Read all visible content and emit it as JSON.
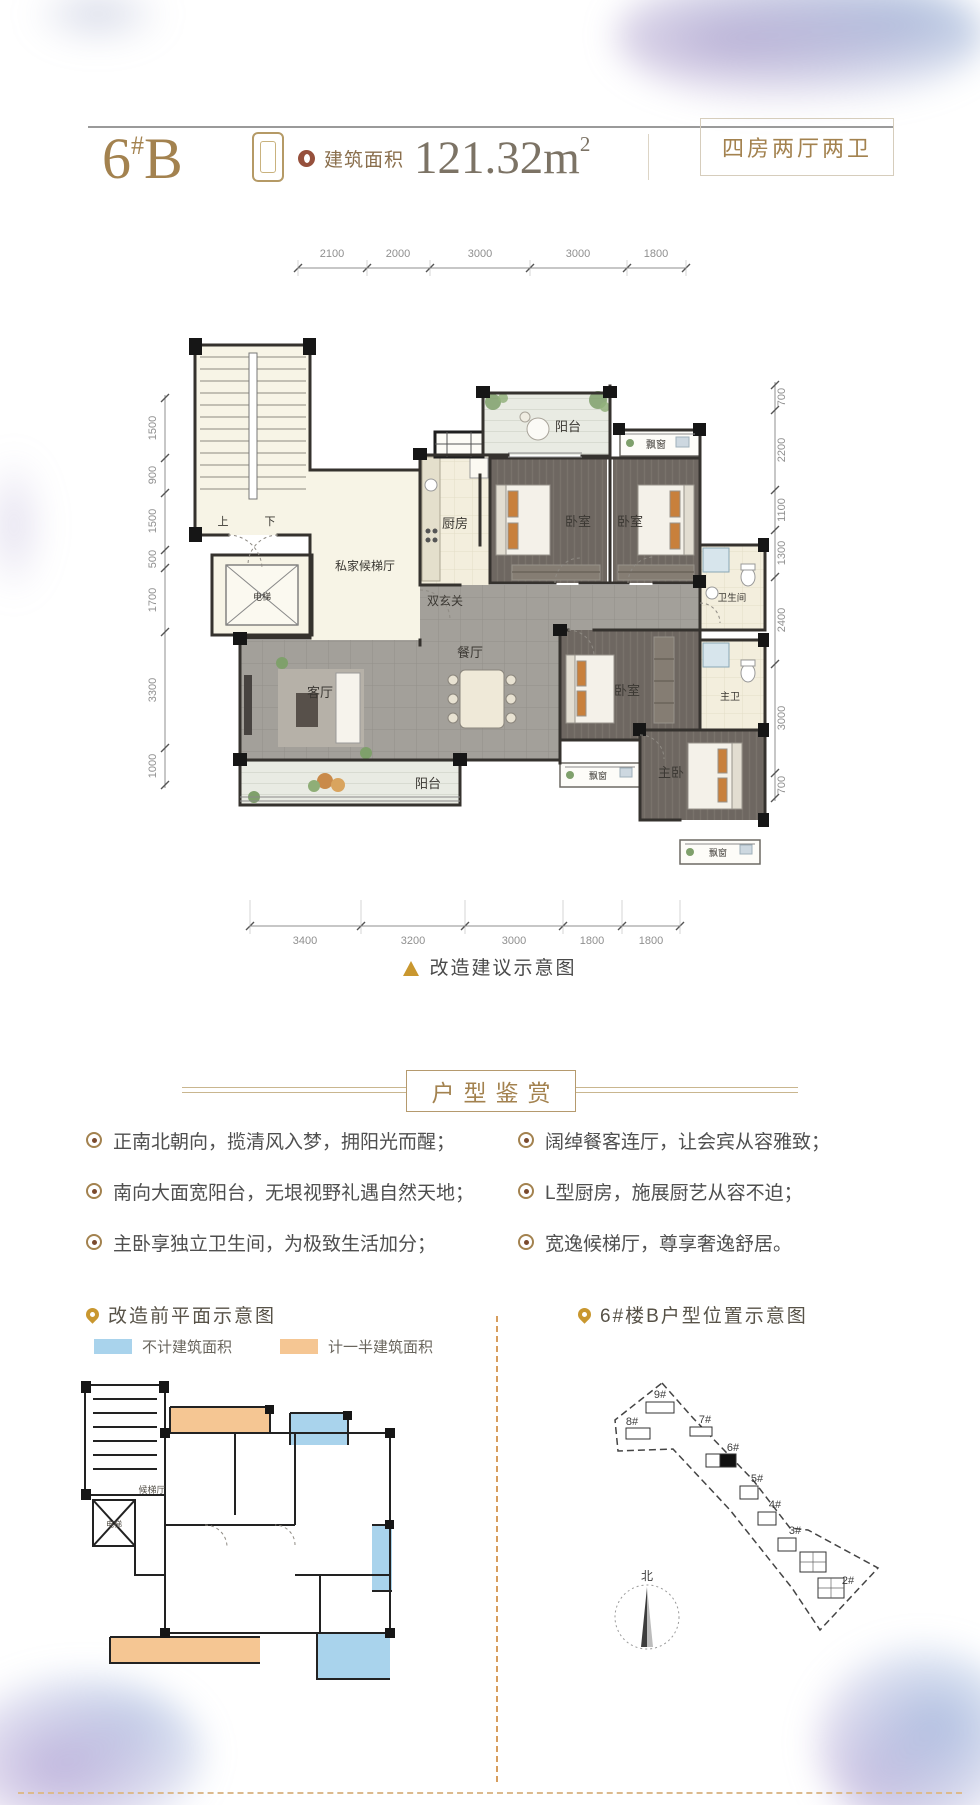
{
  "header": {
    "unit_number": "6",
    "unit_hash": "#",
    "unit_letter": "B",
    "area_label": "建筑面积",
    "area_value": "121.32m",
    "area_sup": "2",
    "layout_tag": "四房两厅两卫"
  },
  "floorplan": {
    "caption": "改造建议示意图",
    "dims_top": [
      "2100",
      "2000",
      "3000",
      "3000",
      "1800"
    ],
    "dims_left": [
      "1500",
      "900",
      "1500",
      "500",
      "1700",
      "3300",
      "1000"
    ],
    "dims_right": [
      "700",
      "2200",
      "1100",
      "1300",
      "2400",
      "3000",
      "700"
    ],
    "dims_bottom": [
      "3400",
      "3200",
      "3000",
      "1800",
      "1800"
    ],
    "labels": {
      "balcony": "阳台",
      "bay_window": "飘窗",
      "kitchen": "厨房",
      "bedroom": "卧室",
      "bathroom": "卫生间",
      "master_bath": "主卫",
      "master_bedroom": "主卧",
      "living": "客厅",
      "dining": "餐厅",
      "double_foyer": "双玄关",
      "private_hall": "私家候梯厅",
      "elevator": "电梯",
      "up": "上",
      "down": "下"
    }
  },
  "appreciation": {
    "title": "户型鉴赏",
    "left_points": [
      "正南北朝向，揽清风入梦，拥阳光而醒；",
      "南向大面宽阳台，无垠视野礼遇自然天地；",
      "主卧享独立卫生间，为极致生活加分；"
    ],
    "right_points": [
      "阔绰餐客连厅，让会宾从容雅致；",
      "L型厨房，施展厨艺从容不迫；",
      "宽逸候梯厅，尊享奢逸舒居。"
    ]
  },
  "before_plan": {
    "title": "改造前平面示意图",
    "legend": [
      {
        "label": "不计建筑面积",
        "color": "#a9d3ec"
      },
      {
        "label": "计一半建筑面积",
        "color": "#f5c693"
      }
    ],
    "labels": {
      "hall": "候梯厅",
      "elevator": "电梯"
    }
  },
  "location_map": {
    "title": "6#楼B户型位置示意图",
    "buildings": [
      "9#",
      "8#",
      "7#",
      "6#",
      "5#",
      "4#",
      "3#",
      "2#"
    ],
    "compass": "北"
  },
  "colors": {
    "gold": "#a3824f",
    "body_text": "#4f4f4f",
    "legend_blue": "#a9d3ec",
    "legend_orange": "#f5c693"
  }
}
